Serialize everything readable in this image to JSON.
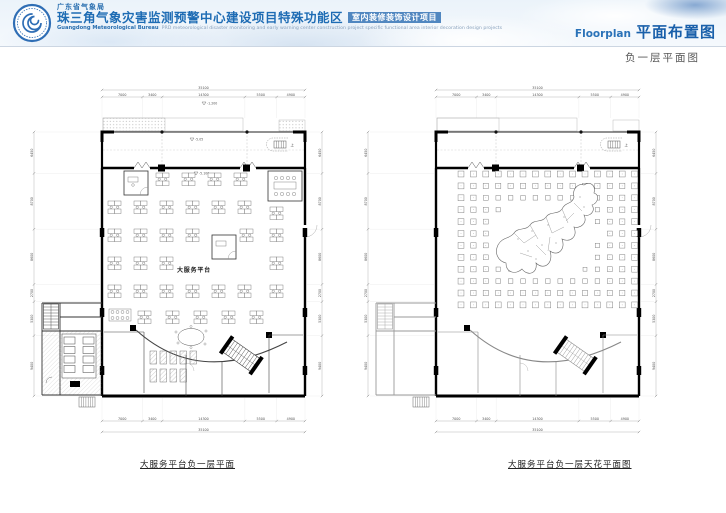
{
  "header": {
    "dept_cn": "广东省气象局",
    "title_cn": "珠三角气象灾害监测预警中心建设项目特殊功能区",
    "title_tag": "室内装修装饰设计项目",
    "dept_en": "Guangdong Meteorological Bureau",
    "desc_en": "PRD meteorological disaster monitoring and early warning center construction project specific functional area interior decoration design projects",
    "section_en": "Floorplan",
    "section_cn": "平面布置图",
    "page_subtitle": "负一层平面图",
    "accent": "#2a72b8"
  },
  "plans": [
    {
      "id": "floor",
      "caption": "大服务平台负一层平面",
      "hall_label": "大服务平台",
      "stair_up_label": "上",
      "level_markers": [
        "-1.200",
        "-5.05",
        "-5.100"
      ],
      "dims": {
        "top": [
          "7000",
          "3400",
          "14300",
          "5500",
          "4900"
        ],
        "top_total": "35100",
        "bottom": [
          "7000",
          "3400",
          "14300",
          "5500",
          "4900"
        ],
        "bottom_total": "35100",
        "left": [
          "6450",
          "8700",
          "8600",
          "2700",
          "5300",
          "9400"
        ],
        "right": [
          "6450",
          "8700",
          "8600",
          "2700",
          "5300",
          "9400"
        ]
      }
    },
    {
      "id": "ceiling",
      "caption": "大服务平台负一层天花平面图",
      "stair_up_label": "上",
      "level_markers": [],
      "dims": {
        "top": [
          "7000",
          "3400",
          "14300",
          "5500",
          "4900"
        ],
        "top_total": "35100",
        "bottom": [
          "7000",
          "3400",
          "14300",
          "5500",
          "4900"
        ],
        "bottom_total": "35100",
        "left": [
          "6450",
          "8700",
          "8600",
          "2700",
          "5300",
          "9400"
        ],
        "right": [
          "6450",
          "8700",
          "8600",
          "2700",
          "5300",
          "9400"
        ]
      }
    }
  ],
  "ceiling_grid": {
    "rows": 12,
    "cols": 15
  }
}
